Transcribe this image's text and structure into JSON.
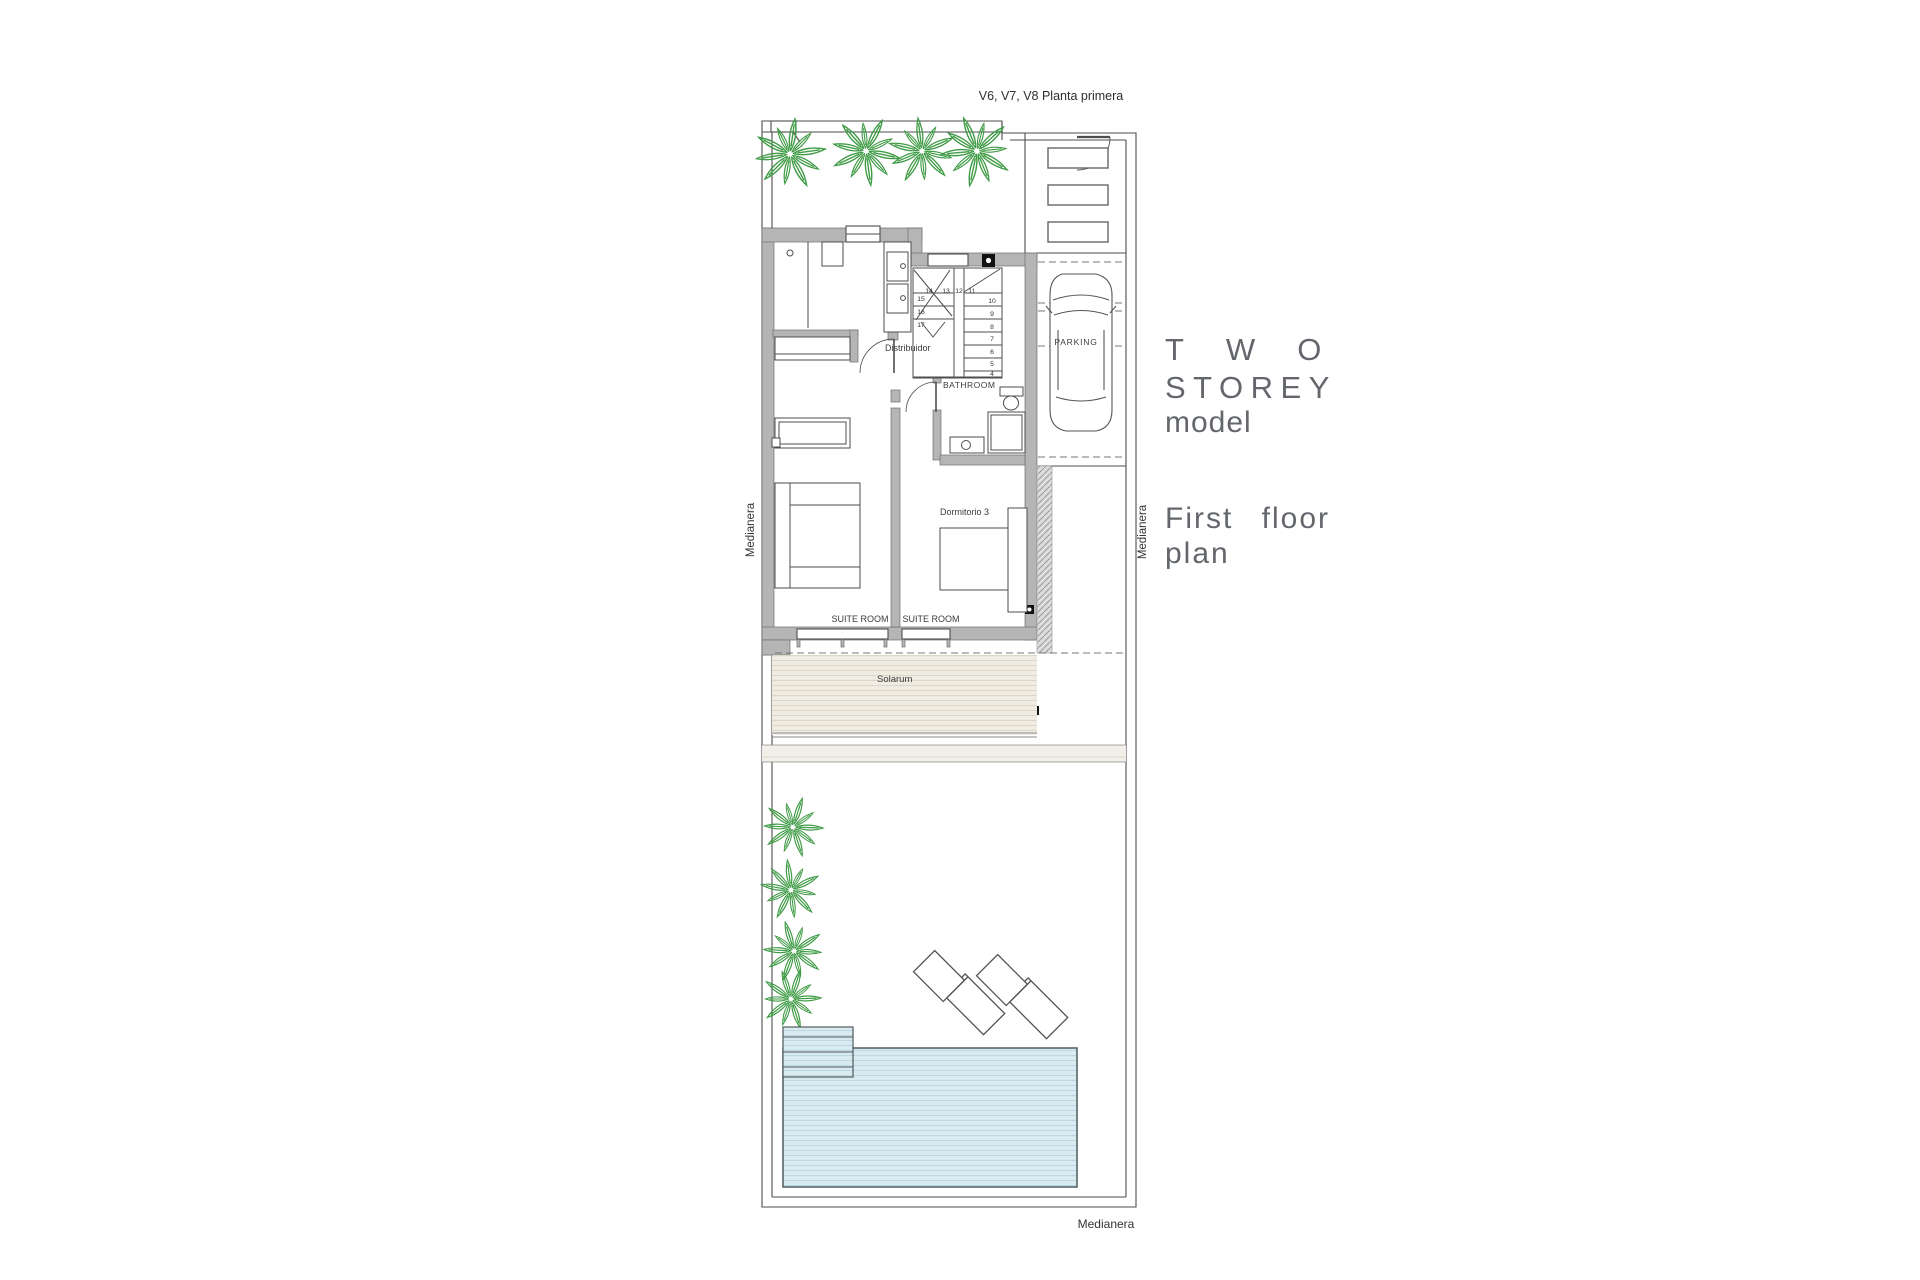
{
  "title": "V6, V7, V8 Planta primera",
  "panel_text": {
    "two": "TWO",
    "storey": "STOREY",
    "model": "model",
    "first_floor": "First floor",
    "plan": "plan"
  },
  "plan_labels": {
    "distribuidor": "Distribuidor",
    "bathroom": "BATHROOM",
    "dormitorio_3": "Dormitorio 3",
    "suite_room_left": "SUITE ROOM",
    "suite_room_right": "SUITE ROOM",
    "solarium": "Solarum",
    "parking": "PARKING"
  },
  "boundary_labels": {
    "medianera_left": "Medianera",
    "medianera_right": "Medianera",
    "medianera_bottom": "Medianera"
  },
  "stairs": {
    "numbers": {
      "n4": "4",
      "n5": "5",
      "n6": "6",
      "n7": "7",
      "n8": "8",
      "n9": "9",
      "n10": "10",
      "n11": "11",
      "n12": "12",
      "n13": "13",
      "n14": "14",
      "n15": "15",
      "n16": "16",
      "n17": "17"
    }
  },
  "colors": {
    "wall": "#b5b5b5",
    "line": "#4d4d4d",
    "palm_green": "#3f9b45",
    "pool_fill": "#d9ebf1",
    "solarium_fill": "#efece4",
    "text_gray": "#63676c",
    "label_dark": "#3c3c3c"
  }
}
